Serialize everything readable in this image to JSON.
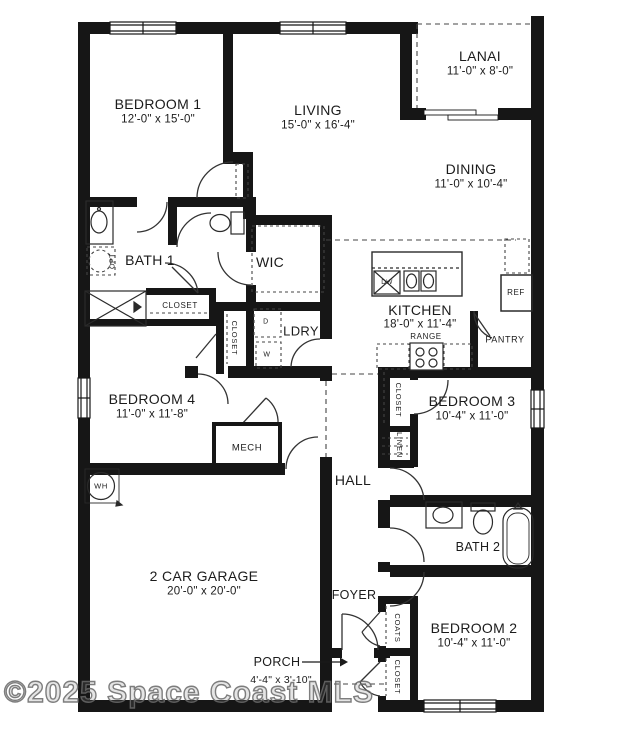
{
  "watermark": "©2025 Space Coast MLS",
  "colors": {
    "wall": "#161616",
    "line": "#333333",
    "background": "#ffffff",
    "watermark_gray": "#8f8f8f"
  },
  "rooms": {
    "bedroom1": {
      "name": "BEDROOM 1",
      "dims": "12'-0\" x 15'-0\""
    },
    "living": {
      "name": "LIVING",
      "dims": "15'-0\" x 16'-4\""
    },
    "lanai": {
      "name": "LANAI",
      "dims": "11'-0\" x 8'-0\""
    },
    "dining": {
      "name": "DINING",
      "dims": "11'-0\" x 10'-4\""
    },
    "bath1": {
      "name": "BATH 1"
    },
    "wic": {
      "name": "WIC"
    },
    "kitchen": {
      "name": "KITCHEN",
      "dims": "18'-0\" x 11'-4\""
    },
    "ldry": {
      "name": "LDRY"
    },
    "bedroom4": {
      "name": "BEDROOM 4",
      "dims": "11'-0\" x 11'-8\""
    },
    "bedroom3": {
      "name": "BEDROOM 3",
      "dims": "10'-4\" x 11'-0\""
    },
    "hall": {
      "name": "HALL"
    },
    "bath2": {
      "name": "BATH 2"
    },
    "garage": {
      "name": "2 CAR GARAGE",
      "dims": "20'-0\" x 20'-0\""
    },
    "foyer": {
      "name": "FOYER"
    },
    "bedroom2": {
      "name": "BEDROOM 2",
      "dims": "10'-4\" x 11'-0\""
    },
    "porch": {
      "name": "PORCH",
      "dims": "4'-4\" x 3'-10\""
    }
  },
  "features": {
    "closet_bath1": "CLOSET",
    "closet_bed4": "CLOSET",
    "closet_bed3": "CLOSET",
    "closet_bed2": "CLOSET",
    "linen": "LINEN",
    "coats": "COATS",
    "mech": "MECH",
    "pantry": "PANTRY",
    "range": "RANGE",
    "ref": "REF",
    "wh": "WH",
    "dw": "DW",
    "dryer": "D",
    "washer": "W",
    "opt": "OPT"
  }
}
